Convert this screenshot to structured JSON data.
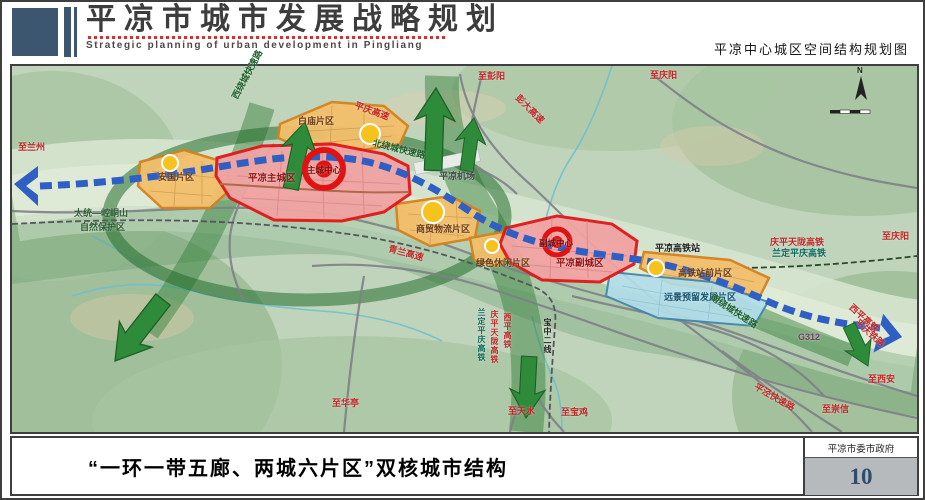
{
  "header": {
    "title": "平凉市城市发展战略规划",
    "subtitle": "Strategic planning of urban development in Pingliang",
    "map_title": "平凉中心城区空间结构规划图"
  },
  "footer": {
    "caption": "“一环一带五廊、两城六片区”双核城市结构",
    "org": "平凉市委市政府",
    "page_number": "10"
  },
  "map": {
    "compass": "N",
    "labels": [
      {
        "name": "to-lanzhou",
        "text": "至兰州"
      },
      {
        "name": "nature-reserve-line1",
        "text": "太统—崆峒山"
      },
      {
        "name": "nature-reserve-line2",
        "text": "自然保护区"
      },
      {
        "name": "anguo-district",
        "text": "安国片区"
      },
      {
        "name": "west-ring-expressway",
        "text": "西绕城快速路"
      },
      {
        "name": "baimiao-district",
        "text": "白庙片区"
      },
      {
        "name": "pingqing-expressway",
        "text": "平庆高速"
      },
      {
        "name": "north-ring-expressway",
        "text": "北绕城快速路"
      },
      {
        "name": "main-city",
        "text": "平凉主城区"
      },
      {
        "name": "main-city-center",
        "text": "主城中心"
      },
      {
        "name": "airport",
        "text": "平凉机场"
      },
      {
        "name": "to-pengyang",
        "text": "至彭阳"
      },
      {
        "name": "pengda-expressway",
        "text": "彭大高速"
      },
      {
        "name": "to-qingyang-north",
        "text": "至庆阳"
      },
      {
        "name": "trade-logistics-district",
        "text": "商贸物流片区"
      },
      {
        "name": "green-leisure-district",
        "text": "绿色休闲片区"
      },
      {
        "name": "sub-city-center",
        "text": "副城中心"
      },
      {
        "name": "sub-city",
        "text": "平凉副城区"
      },
      {
        "name": "hsr-station",
        "text": "平凉高铁站"
      },
      {
        "name": "qingping-tianlong-hsr",
        "text": "庆平天陇高铁"
      },
      {
        "name": "landing-pingqing-hsr",
        "text": "兰定平庆高铁"
      },
      {
        "name": "to-qingyang-east",
        "text": "至庆阳"
      },
      {
        "name": "hsr-front-district",
        "text": "高铁站前片区"
      },
      {
        "name": "reserved-development-district",
        "text": "远景预留发展片区"
      },
      {
        "name": "south-ring-expressway",
        "text": "南绕城快速路"
      },
      {
        "name": "g312",
        "text": "G312"
      },
      {
        "name": "xiping-hsr",
        "text": "西平高铁"
      },
      {
        "name": "pingqing-railway",
        "text": "平庆铁路"
      },
      {
        "name": "to-xian",
        "text": "至西安"
      },
      {
        "name": "pingjing-expressway",
        "text": "平泾快速路"
      },
      {
        "name": "to-chongxin",
        "text": "至崇信"
      },
      {
        "name": "to-huating",
        "text": "至华亭"
      },
      {
        "name": "to-tianshui",
        "text": "至天水"
      },
      {
        "name": "to-baoji",
        "text": "至宝鸡"
      },
      {
        "name": "qinglan-expressway",
        "text": "青兰高速"
      },
      {
        "name": "landing-pingqing-hsr-south",
        "text": "兰定平庆高铁"
      },
      {
        "name": "qingping-tianlong-hsr-south",
        "text": "庆平天陇高铁"
      },
      {
        "name": "xiping-hsr-south",
        "text": "西平高铁"
      },
      {
        "name": "baozhong-second-line",
        "text": "宝中二线"
      }
    ]
  },
  "colors": {
    "brand_slate": "#3b566e",
    "city_red": "#e01818",
    "district_orange": "#d4821e",
    "reserved_blue": "#3f86ac",
    "corridor_green": "#2e8b3a",
    "transit_blue": "#2f5ec4",
    "node_yellow": "#f6c21e"
  }
}
